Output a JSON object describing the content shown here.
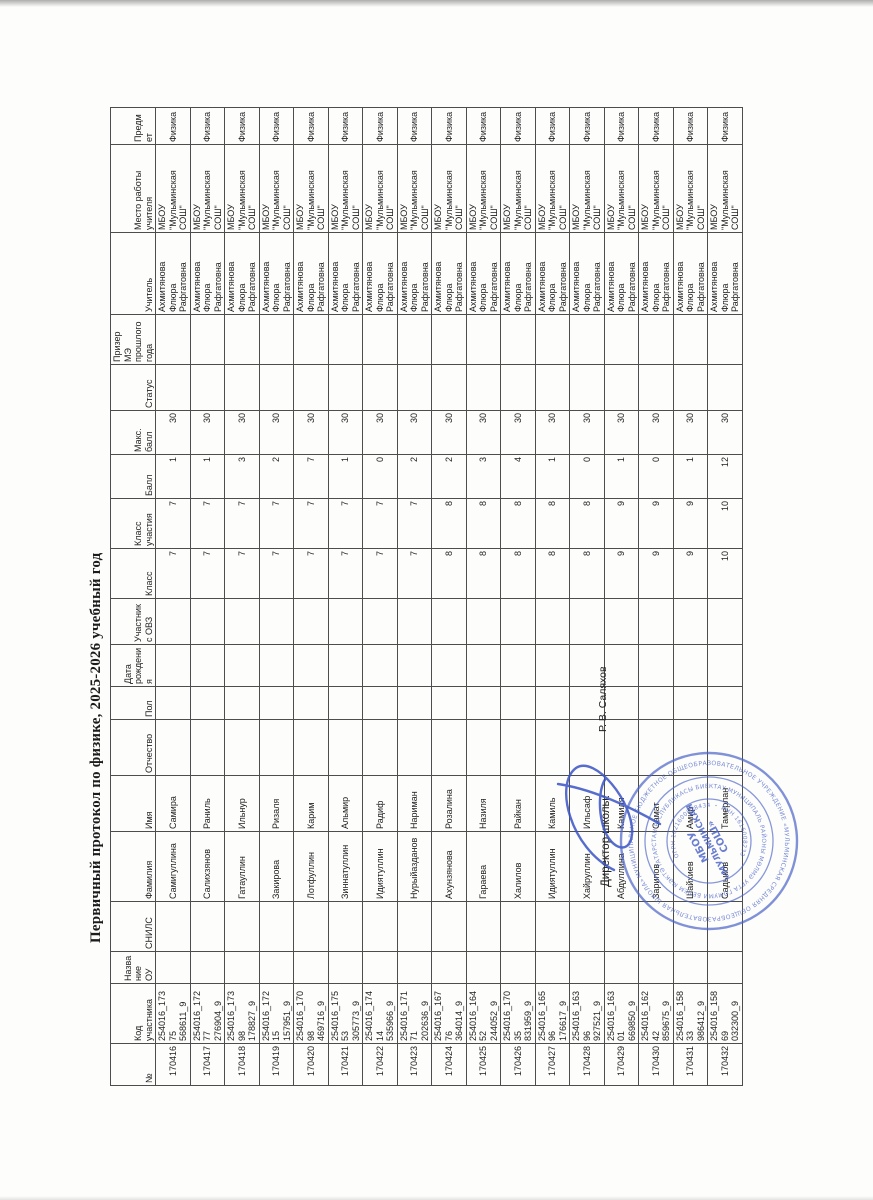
{
  "document": {
    "title": "Первичный протокол по физике, 2025-2026 учебный год",
    "signature": {
      "label": "Директор школы:",
      "name": "Р. В. Саляхов"
    }
  },
  "table": {
    "headers": [
      "№",
      "Код участника",
      "Название ОУ",
      "СНИЛС",
      "Фамилия",
      "Имя",
      "Отчество",
      "Пол",
      "Дата рождения",
      "Участник с ОВЗ",
      "Класс",
      "Класс участия",
      "Балл",
      "Макс. балл",
      "Статус",
      "Призер МЭ прошлого года",
      "Учитель",
      "Место работы учителя",
      "Предмет"
    ],
    "rows": [
      [
        "170416",
        "254016_17375\n568611_9",
        "",
        "",
        "Самигуллина",
        "Самира",
        "",
        "",
        "",
        "",
        "7",
        "7",
        "1",
        "30",
        "",
        "",
        "Ахмитянова Флюра Рафгатовна",
        "МБОУ \"Мульминская СОШ\"",
        "Физика"
      ],
      [
        "170417",
        "254016_17277\n276904_9",
        "",
        "",
        "Салихзянов",
        "Раниль",
        "",
        "",
        "",
        "",
        "7",
        "7",
        "1",
        "30",
        "",
        "",
        "Ахмитянова Флюра Рафгатовна",
        "МБОУ \"Мульминская СОШ\"",
        "Физика"
      ],
      [
        "170418",
        "254016_17398\n178827_9",
        "",
        "",
        "Гатауллин",
        "Ильнур",
        "",
        "",
        "",
        "",
        "7",
        "7",
        "3",
        "30",
        "",
        "",
        "Ахмитянова Флюра Рафгатовна",
        "МБОУ \"Мульминская СОШ\"",
        "Физика"
      ],
      [
        "170419",
        "254016_17215\n157951_9",
        "",
        "",
        "Закирова",
        "Ризаля",
        "",
        "",
        "",
        "",
        "7",
        "7",
        "2",
        "30",
        "",
        "",
        "Ахмитянова Флюра Рафгатовна",
        "МБОУ \"Мульминская СОШ\"",
        "Физика"
      ],
      [
        "170420",
        "254016_17098\n469716_9",
        "",
        "",
        "Лотфуллин",
        "Карим",
        "",
        "",
        "",
        "",
        "7",
        "7",
        "7",
        "30",
        "",
        "",
        "Ахмитянова Флюра Рафгатовна",
        "МБОУ \"Мульминская СОШ\"",
        "Физика"
      ],
      [
        "170421",
        "254016_17553\n305773_9",
        "",
        "",
        "Зиннатуллин",
        "Альмир",
        "",
        "",
        "",
        "",
        "7",
        "7",
        "1",
        "30",
        "",
        "",
        "Ахмитянова Флюра Рафгатовна",
        "МБОУ \"Мульминская СОШ\"",
        "Физика"
      ],
      [
        "170422",
        "254016_17414\n535966_9",
        "",
        "",
        "Идиятуллин",
        "Радиф",
        "",
        "",
        "",
        "",
        "7",
        "7",
        "0",
        "30",
        "",
        "",
        "Ахмитянова Флюра Рафгатовна",
        "МБОУ \"Мульминская СОШ\"",
        "Физика"
      ],
      [
        "170423",
        "254016_17171\n202636_9",
        "",
        "",
        "Нурыйазданов",
        "Нариман",
        "",
        "",
        "",
        "",
        "7",
        "7",
        "2",
        "30",
        "",
        "",
        "Ахмитянова Флюра Рафгатовна",
        "МБОУ \"Мульминская СОШ\"",
        "Физика"
      ],
      [
        "170424",
        "254016_16776\n364014_9",
        "",
        "",
        "Ахунзянова",
        "Розалина",
        "",
        "",
        "",
        "",
        "8",
        "8",
        "2",
        "30",
        "",
        "",
        "Ахмитянова Флюра Рафгатовна",
        "МБОУ \"Мульминская СОШ\"",
        "Физика"
      ],
      [
        "170425",
        "254016_16452\n244052_9",
        "",
        "",
        "Гараева",
        "Назиля",
        "",
        "",
        "",
        "",
        "8",
        "8",
        "3",
        "30",
        "",
        "",
        "Ахмитянова Флюра Рафгатовна",
        "МБОУ \"Мульминская СОШ\"",
        "Физика"
      ],
      [
        "170426",
        "254016_17035\n831959_9",
        "",
        "",
        "Халилов",
        "Райкан",
        "",
        "",
        "",
        "",
        "8",
        "8",
        "4",
        "30",
        "",
        "",
        "Ахмитянова Флюра Рафгатовна",
        "МБОУ \"Мульминская СОШ\"",
        "Физика"
      ],
      [
        "170427",
        "254016_16596\n176617_9",
        "",
        "",
        "Идиятуллин",
        "Камиль",
        "",
        "",
        "",
        "",
        "8",
        "8",
        "1",
        "30",
        "",
        "",
        "Ахмитянова Флюра Рафгатовна",
        "МБОУ \"Мульминская СОШ\"",
        "Физика"
      ],
      [
        "170428",
        "254016_16396\n927521_9",
        "",
        "",
        "Хайруллин",
        "Ильсаф",
        "",
        "",
        "",
        "",
        "8",
        "8",
        "0",
        "30",
        "",
        "",
        "Ахмитянова Флюра Рафгатовна",
        "МБОУ \"Мульминская СОШ\"",
        "Физика"
      ],
      [
        "170429",
        "254016_16301\n669850_9",
        "",
        "",
        "Абдуллина",
        "Камиля",
        "",
        "",
        "",
        "",
        "9",
        "9",
        "1",
        "30",
        "",
        "",
        "Ахмитянова Флюра Рафгатовна",
        "МБОУ \"Мульминская СОШ\"",
        "Физика"
      ],
      [
        "170430",
        "254016_16242\n859675_9",
        "",
        "",
        "Зарипов",
        "Самат",
        "",
        "",
        "",
        "",
        "9",
        "9",
        "0",
        "30",
        "",
        "",
        "Ахмитянова Флюра Рафгатовна",
        "МБОУ \"Мульминская СОШ\"",
        "Физика"
      ],
      [
        "170431",
        "254016_15833\n986412_9",
        "",
        "",
        "Шайхиев",
        "Амир",
        "",
        "",
        "",
        "",
        "9",
        "9",
        "1",
        "30",
        "",
        "",
        "Ахмитянова Флюра Рафгатовна",
        "МБОУ \"Мульминская СОШ\"",
        "Физика"
      ],
      [
        "170432",
        "254016_15869\n032300_9",
        "",
        "",
        "Садыков",
        "Тамерлан",
        "",
        "",
        "",
        "",
        "10",
        "10",
        "12",
        "30",
        "",
        "",
        "Ахмитянова Флюра Рафгатовна",
        "МБОУ \"Мульминская СОШ\"",
        "Физика"
      ]
    ]
  },
  "stamp": {
    "ring_outer": "МУНИЦИПАЛЬНОЕ БЮДЖЕТНОЕ ОБЩЕОБРАЗОВАТЕЛЬНОЕ УЧРЕЖДЕНИЕ «МУЛЬМИНСКАЯ СРЕДНЯЯ ОБЩЕОБРАЗОВАТЕЛЬНАЯ ШКОЛА» ВЫСОКОГОРСКОГО МУНИЦИПАЛЬНОГО РАЙОНА",
    "ring_middle": "ТАТАРСТАН РЕСПУБЛИКАСЫ БИЕКТАУ МУНИЦИПАЛЬ РАЙОНЫ МӨЛМӘ УРТА ГОМУМИ БЕЛЕМ МӘКТӘБЕ ・ РЕСПУБЛИКИ ТАТАРСТАН ・",
    "ring_inner": "ОГРН 1021600818434 ・ ИНН 1616008233",
    "center_line1": "МБОУ",
    "center_line2": "«МУЛЬМИНСКАЯ",
    "center_line3": "СОШ»",
    "ink_color": "#4a63c8"
  },
  "colors": {
    "paper": "#fdfdfc",
    "table_border": "#4d4d4d",
    "text": "#222222",
    "signature_ink": "#3b55c5"
  }
}
